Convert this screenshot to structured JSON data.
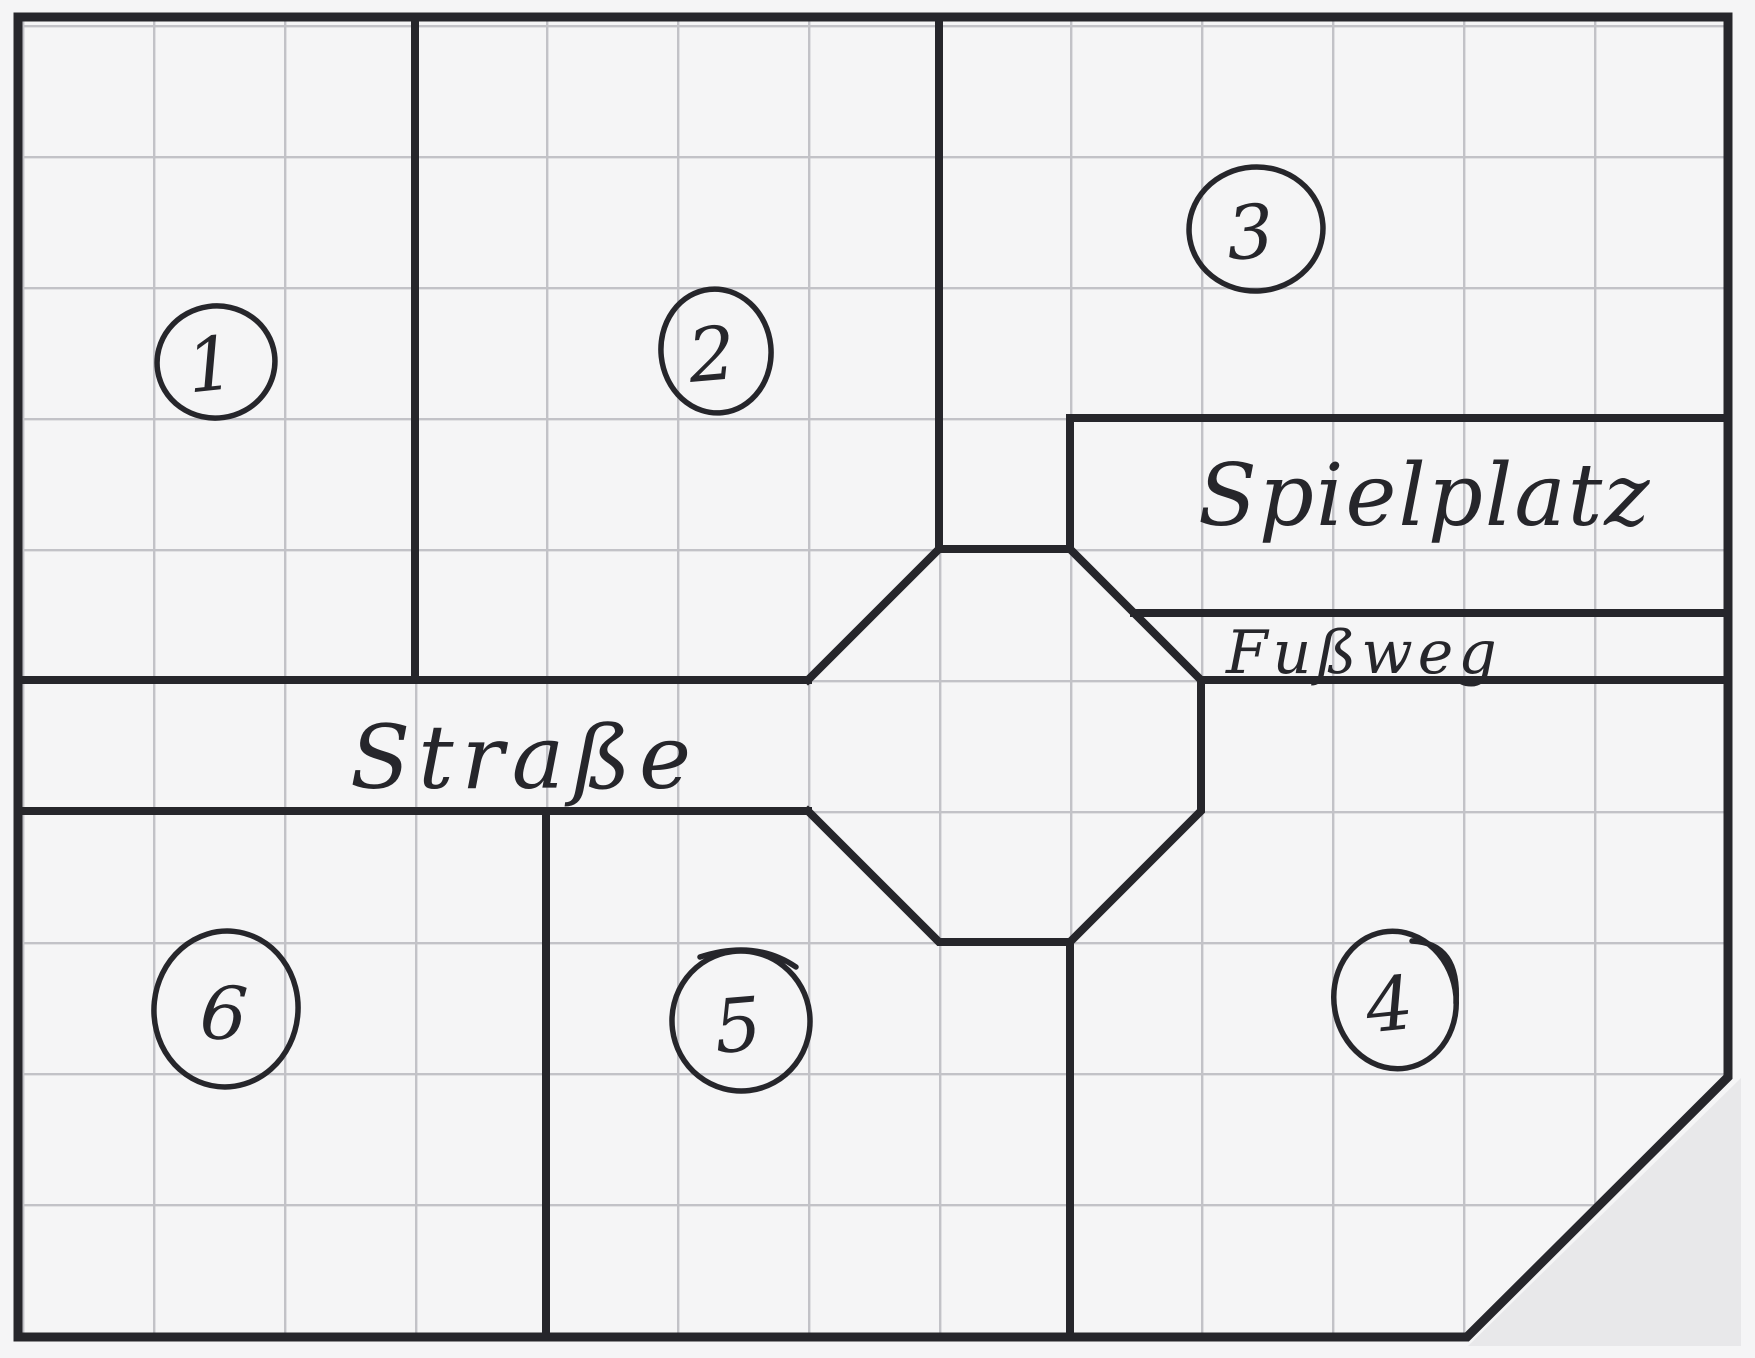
{
  "document": {
    "kind": "hand-drawn neighborhood plan sketch on grid paper",
    "language": "German"
  },
  "colors": {
    "paper": "#f5f5f6",
    "grid_line": "#c2c2c7",
    "ink": "#26262b",
    "cut_corner_fill": "#e8e8ea"
  },
  "labels": {
    "plot1": "1",
    "plot2": "2",
    "plot3": "3",
    "plot4": "4",
    "plot5": "5",
    "plot6": "6",
    "street": "Straße",
    "playground": "Spielplatz",
    "footpath": "Fußweg"
  },
  "map": {
    "plots": [
      {
        "number": "1",
        "position": "top-left"
      },
      {
        "number": "2",
        "position": "top-middle"
      },
      {
        "number": "3",
        "position": "top-right"
      },
      {
        "number": "4",
        "position": "bottom-right"
      },
      {
        "number": "5",
        "position": "bottom-middle"
      },
      {
        "number": "6",
        "position": "bottom-left"
      }
    ],
    "areas": [
      {
        "name": "Straße",
        "type": "street",
        "note": "horizontal road band ending in an octagonal intersection"
      },
      {
        "name": "Spielplatz",
        "type": "playground",
        "note": "strip on the right side above the footpath"
      },
      {
        "name": "Fußweg",
        "type": "footpath",
        "note": "narrow strip below the playground"
      }
    ],
    "features": [
      "octagonal intersection in the center-right",
      "bottom-right corner of the plan is cut diagonally"
    ]
  }
}
